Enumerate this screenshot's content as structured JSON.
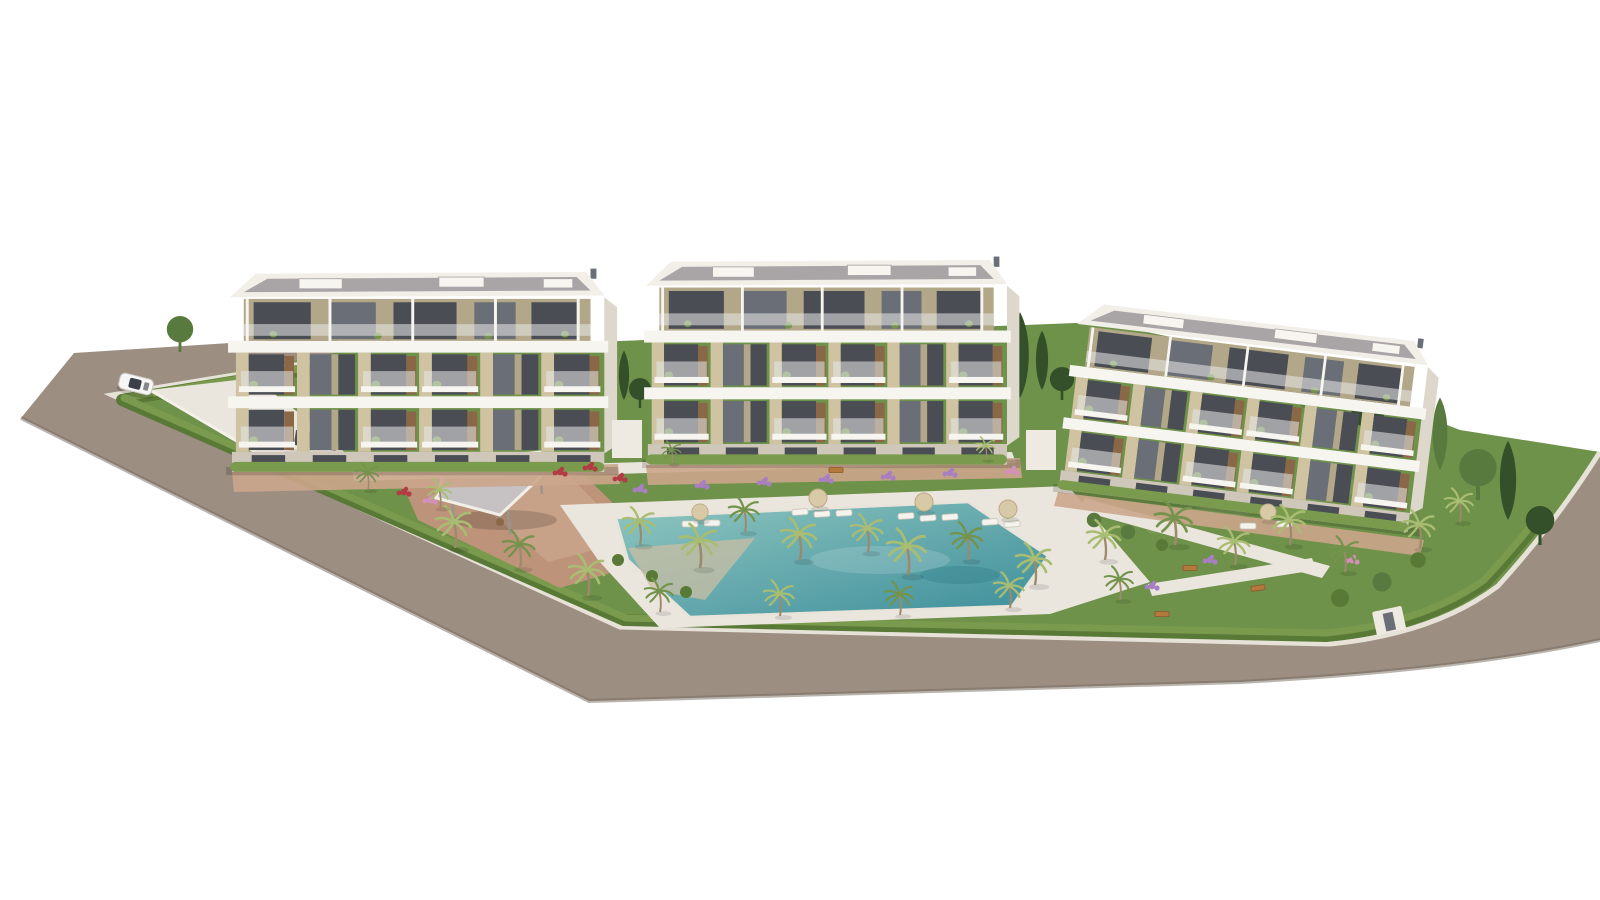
{
  "palette": {
    "background": "#ffffff",
    "road": "#9d8e82",
    "road_edge_dark": "#76695e",
    "curb": "#e7e2d8",
    "hedge": "#7a9a4d",
    "hedge_dark": "#597a36",
    "grass": "#6f924a",
    "grass_light": "#85aa5e",
    "tree_green": "#587a3e",
    "tree_dark": "#33502a",
    "palm_frond": "#a9bd72",
    "palm_dark": "#74934c",
    "trunk": "#9b8a6b",
    "path": "#eae6de",
    "path_shade": "#d7d1c6",
    "terracotta": "#bd9379",
    "terracotta_light": "#cba68c",
    "pool_deep": "#3d8e9b",
    "pool_light": "#8fc6c0",
    "pool_beach": "#c9bfa4",
    "facade": "#f2efe9",
    "slab": "#f7f5f0",
    "facade_shadow": "#ddd7cc",
    "ground": "#cfc8ba",
    "beige": "#cfc3a2",
    "beige_dark": "#b2a788",
    "glass_dark": "#4a4d54",
    "glass_mid": "#6a6e76",
    "rail_glass": "#e8eae9",
    "wood": "#8a6847",
    "roof": "#a9a5a7",
    "roof_light": "#c6c2c4",
    "umbrella": "#d9caa7",
    "lounger": "#f5f3ee",
    "flower_purple": "#a87fc0",
    "flower_red": "#b43a44",
    "flower_pink": "#d490b8",
    "bench": "#b5793c",
    "car_body": "#f6f6f6",
    "car_glass": "#3c3f45",
    "wall_white": "#eeeae2"
  },
  "objects": {
    "apartment_buildings": 3,
    "levels_per_building": 4,
    "swimming_pool": 1,
    "pool_pavilion": 1,
    "parked_car": 1,
    "garage_ramp": 1,
    "sun_umbrellas": 5,
    "sun_loungers": 12,
    "palm_trees": 27,
    "garden_benches": 4
  }
}
